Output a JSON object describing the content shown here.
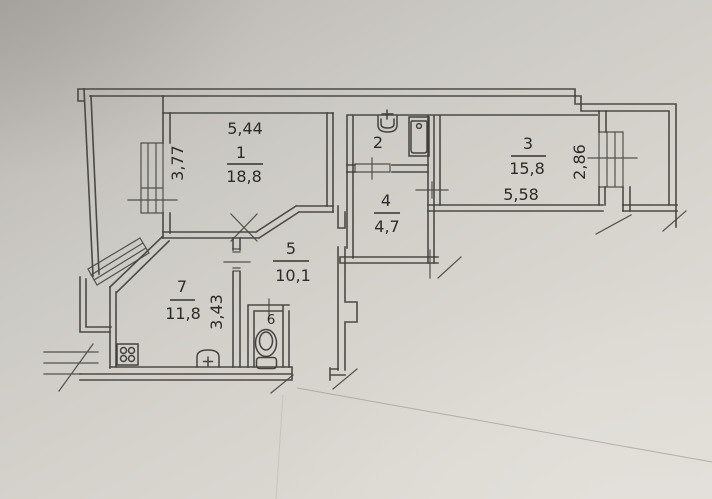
{
  "plan": {
    "type": "apartment-floor-plan",
    "colors": {
      "paper": "#d5d2cc",
      "ink": "#403f3b"
    },
    "rooms": {
      "r1": {
        "number": "1",
        "area": "18,8",
        "width": "5,44",
        "side": "3,77"
      },
      "r2": {
        "number": "2"
      },
      "r3": {
        "number": "3",
        "area": "15,8",
        "width": "5,58",
        "side": "2,86"
      },
      "r4": {
        "number": "4",
        "area": "4,7"
      },
      "r5": {
        "number": "5",
        "area": "10,1"
      },
      "r6": {
        "number": "6"
      },
      "r7": {
        "number": "7",
        "area": "11,8",
        "side": "3,43"
      }
    }
  }
}
